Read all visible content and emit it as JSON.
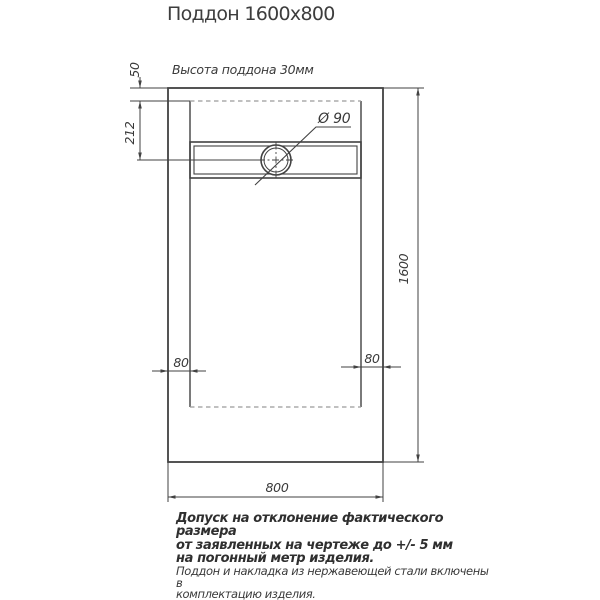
{
  "title": "Поддон 1600x800",
  "drawing": {
    "height_note": "Высота поддона 30мм",
    "dim_top_rim": "50",
    "dim_drain_center": "212",
    "dim_length": "1600",
    "dim_width": "800",
    "dim_side_left": "80",
    "dim_side_right": "80",
    "drain_diameter": "Ø 90"
  },
  "notes": {
    "tolerance": {
      "line1": "Допуск на отклонение фактического размера",
      "line2": "от заявленных на чертеже до +/- 5 мм",
      "line3": "на погонный метр изделия."
    },
    "included": {
      "line1": "Поддон и накладка из нержавеющей стали включены в",
      "line2": "комплектацию изделия."
    },
    "siphon": "Сифон приобретается отдельно."
  },
  "colors": {
    "line": "#424242",
    "dashed_line": "#9b9b9b",
    "text": "#3a3a3a"
  }
}
